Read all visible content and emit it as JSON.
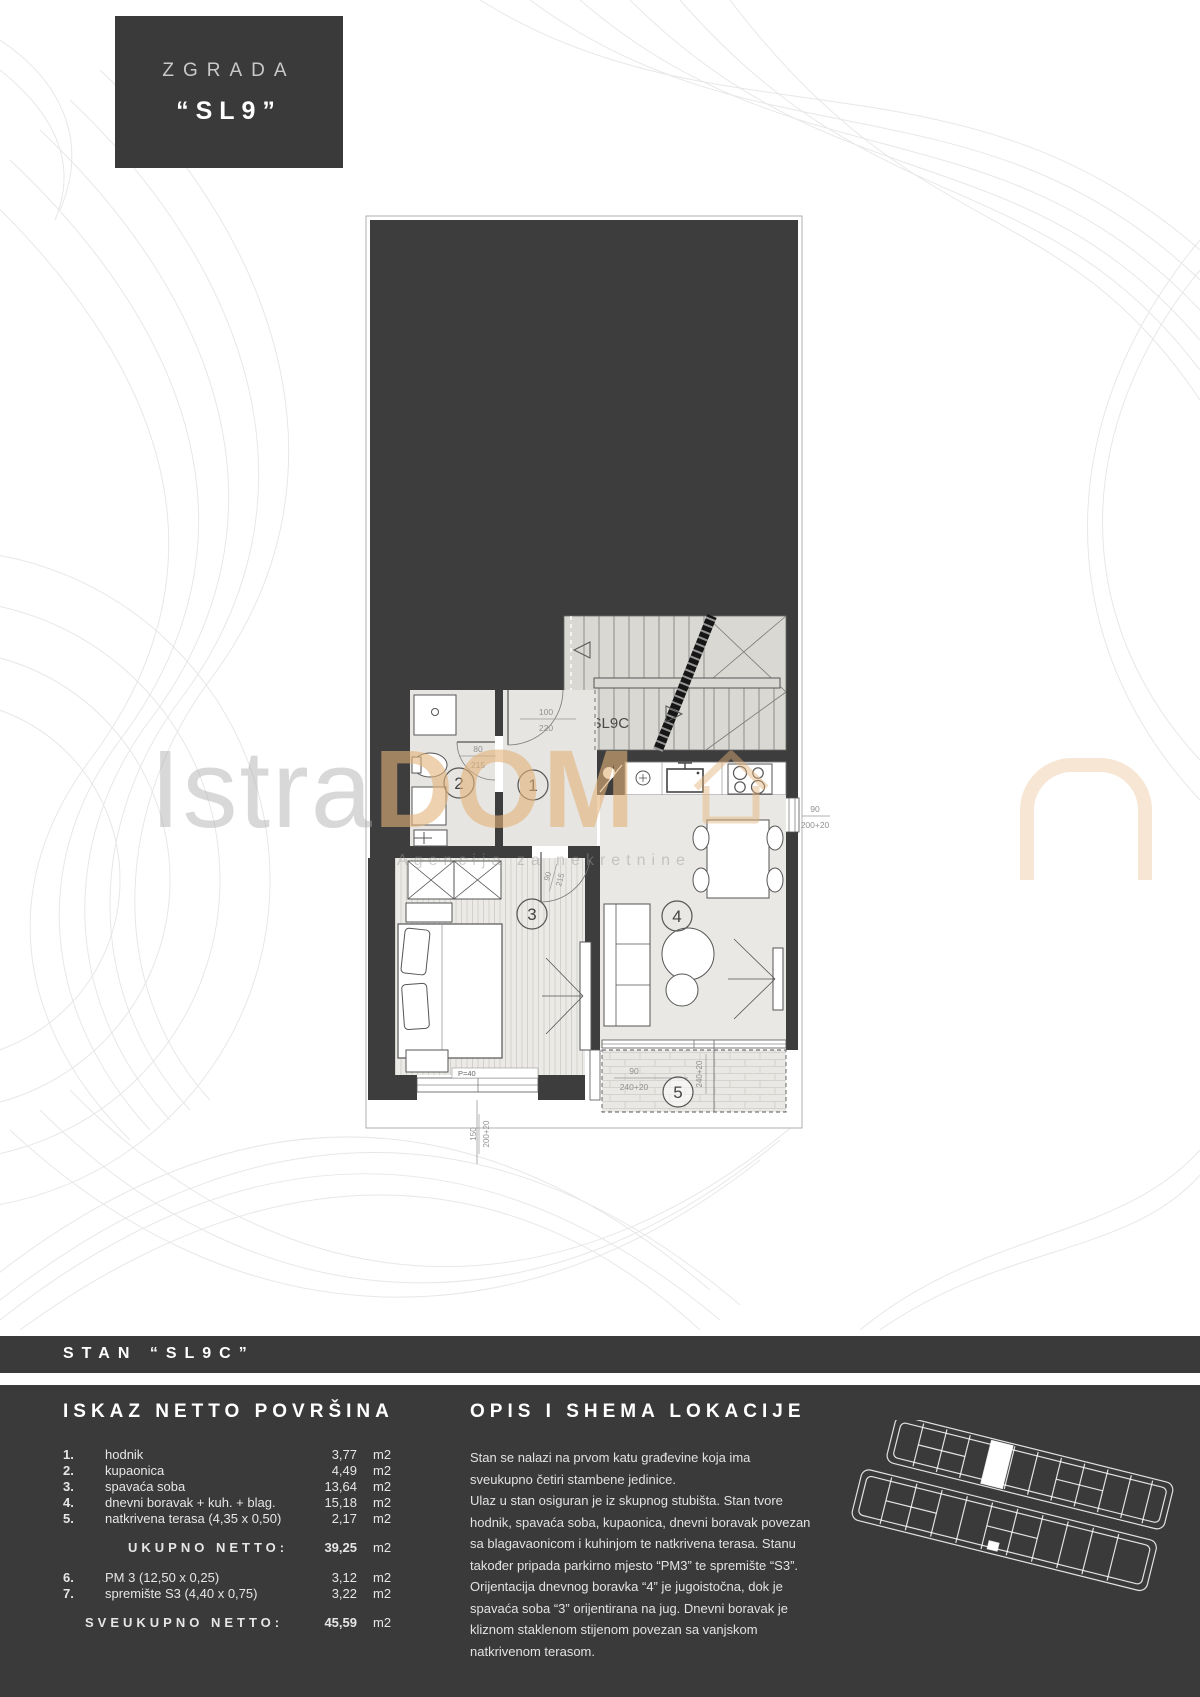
{
  "title_box": {
    "line1": "ZGRADA",
    "line2": "“SL9”"
  },
  "stan_band": {
    "title": "STAN “SL9C”"
  },
  "watermark": {
    "part1": "Istra",
    "part2": "DOM",
    "tagline": "Agencija za nekretnine"
  },
  "plan": {
    "unit_label": "◁SL9C",
    "rooms": {
      "r1": "1",
      "r2": "2",
      "r3": "3",
      "r4": "4",
      "r5": "5"
    },
    "dims": {
      "entry_w": "100",
      "entry_h": "220",
      "bath_w": "80",
      "bath_h": "215",
      "bed_w": "90",
      "bed_h": "215",
      "kwin_w": "90",
      "kwin_h": "200+20",
      "ter_w": "90",
      "ter_h": "240+20",
      "ter_side": "240+20",
      "bwin_w": "150",
      "bwin_h": "200+20",
      "parapet": "P=40"
    },
    "colors": {
      "wall_dark": "#3e3d3d",
      "stair_light": "#d9d8d3",
      "room_light": "#e6e5e1"
    }
  },
  "netto": {
    "heading": "ISKAZ NETTO POVRŠINA",
    "rows": [
      {
        "num": "1.",
        "label": "hodnik",
        "value": "3,77",
        "unit": "m2"
      },
      {
        "num": "2.",
        "label": "kupaonica",
        "value": "4,49",
        "unit": "m2"
      },
      {
        "num": "3.",
        "label": "spavaća soba",
        "value": "13,64",
        "unit": "m2"
      },
      {
        "num": "4.",
        "label": "dnevni boravak + kuh. + blag.",
        "value": "15,18",
        "unit": "m2"
      },
      {
        "num": "5.",
        "label": "natkrivena terasa (4,35 x 0,50)",
        "value": "2,17",
        "unit": "m2"
      }
    ],
    "subtotal": {
      "label": "UKUPNO NETTO:",
      "value": "39,25",
      "unit": "m2"
    },
    "rows2": [
      {
        "num": "6.",
        "label": "PM 3 (12,50 x 0,25)",
        "value": "3,12",
        "unit": "m2"
      },
      {
        "num": "7.",
        "label": "spremište S3 (4,40 x 0,75)",
        "value": "3,22",
        "unit": "m2"
      }
    ],
    "total": {
      "label": "SVEUKUPNO NETTO:",
      "value": "45,59",
      "unit": "m2"
    }
  },
  "opis": {
    "heading": "OPIS I SHEMA LOKACIJE",
    "p1": "Stan se nalazi na prvom katu građevine koja ima sveukupno četiri stambene jedinice.",
    "p2": "Ulaz u stan osiguran je iz skupnog stubišta. Stan tvore hodnik, spavaća soba, kupaonica, dnevni boravak povezan sa blagavaonicom i kuhinjom te natkrivena terasa. Stanu također pripada parkirno mjesto “PM3” te spremište “S3”. Orijentacija dnevnog boravka “4” je jugoistočna, dok je spavaća soba “3” orijentirana na jug. Dnevni boravak je kliznom staklenom stijenom povezan sa vanjskom natkrivenom terasom."
  }
}
